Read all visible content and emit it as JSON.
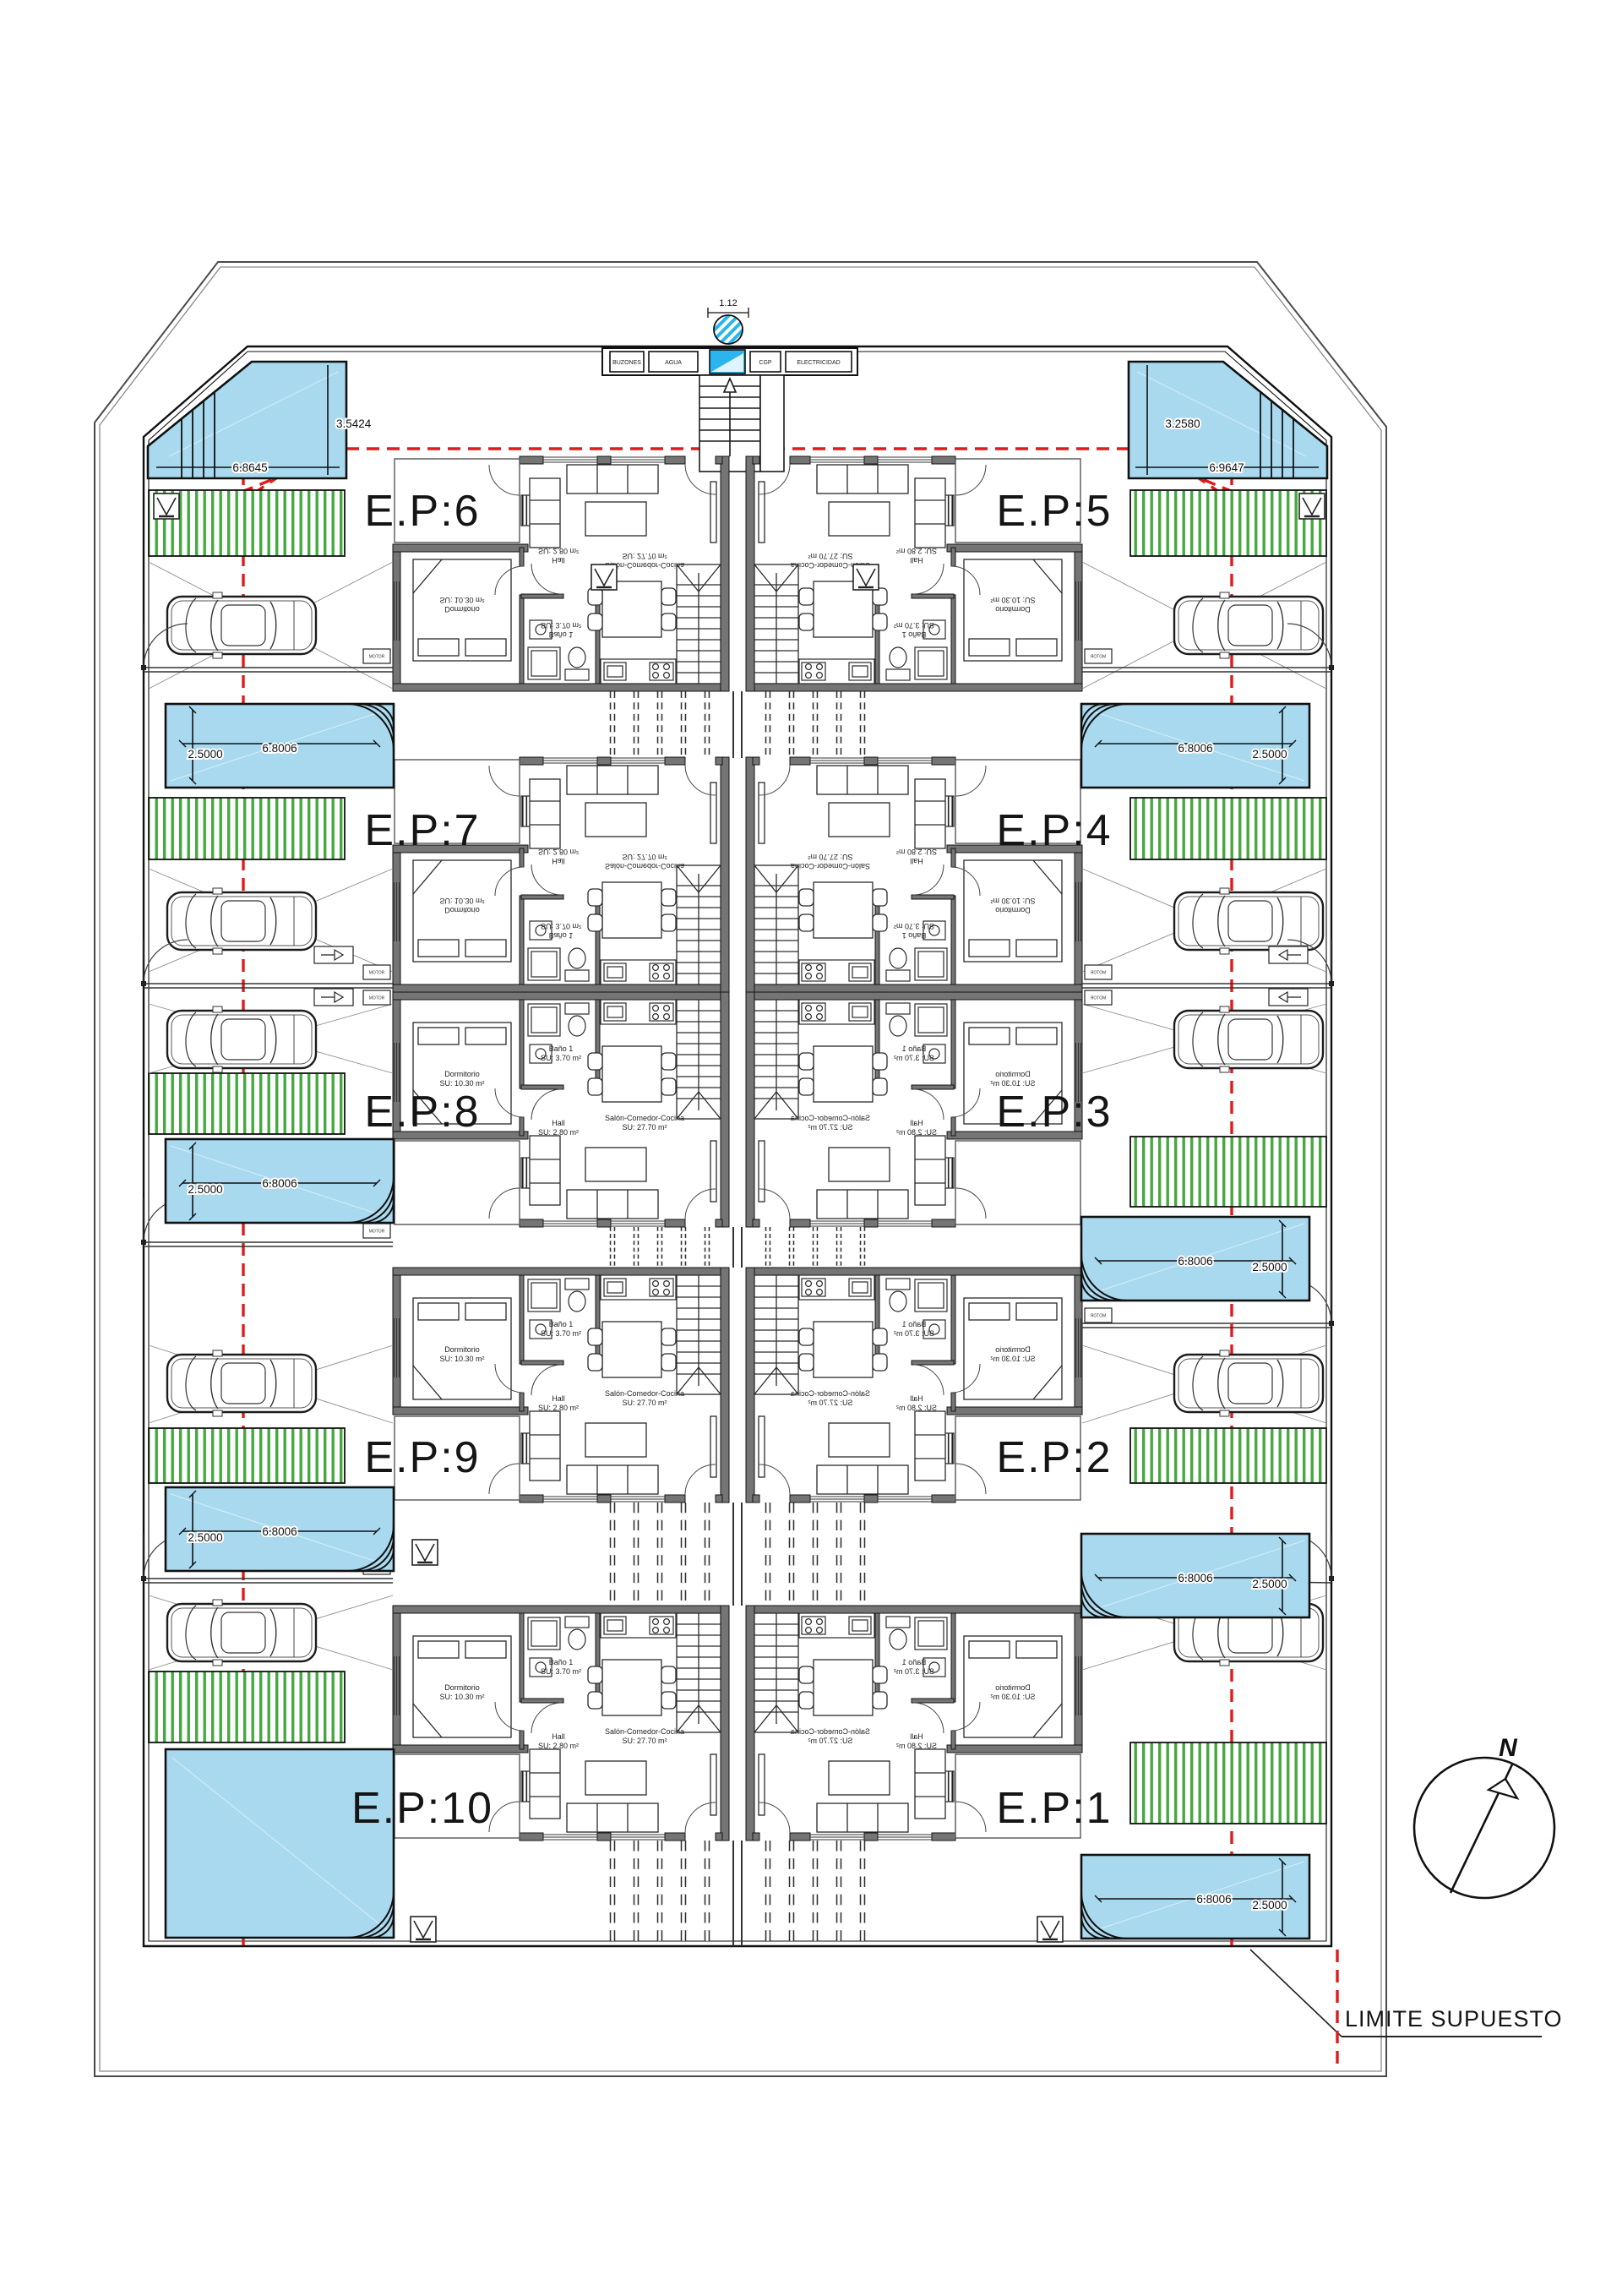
{
  "plan": {
    "units": [
      {
        "id": "ep6",
        "label": "E.P:6"
      },
      {
        "id": "ep5",
        "label": "E.P:5"
      },
      {
        "id": "ep7",
        "label": "E.P:7"
      },
      {
        "id": "ep4",
        "label": "E.P:4"
      },
      {
        "id": "ep8",
        "label": "E.P:8"
      },
      {
        "id": "ep3",
        "label": "E.P:3"
      },
      {
        "id": "ep9",
        "label": "E.P:9"
      },
      {
        "id": "ep2",
        "label": "E.P:2"
      },
      {
        "id": "ep10",
        "label": "E.P:10"
      },
      {
        "id": "ep1",
        "label": "E.P:1"
      }
    ],
    "rooms": {
      "dormitorio": {
        "l1": "Dormitorio",
        "l2": "SU: 10.30 m²"
      },
      "bano": {
        "l1": "Baño 1",
        "l2": "SU: 3.70 m²"
      },
      "hall": {
        "l1": "Hall",
        "l2": "SU: 2.80 m²"
      },
      "salon": {
        "l1": "Salón-Comedor-Cocina",
        "l2": "SU: 27.70 m²"
      }
    },
    "pools": [
      {
        "id": "top-left",
        "width_label": "6.8645",
        "height_label": "3.5424"
      },
      {
        "id": "top-right",
        "width_label": "6.9647",
        "height_label": "3.2580"
      },
      {
        "id": "left-row2",
        "width_label": "6.8006",
        "height_label": "2.5000"
      },
      {
        "id": "left-row3",
        "width_label": "6.8006",
        "height_label": "2.5000"
      },
      {
        "id": "left-row4",
        "width_label": "6.8006",
        "height_label": "2.5000"
      },
      {
        "id": "right-row2",
        "width_label": "6.8006",
        "height_label": "2.5000"
      },
      {
        "id": "right-row3",
        "width_label": "6.8006",
        "height_label": "2.5000"
      },
      {
        "id": "right-row4",
        "width_label": "6.8006",
        "height_label": "2.5000"
      },
      {
        "id": "bottom-right",
        "width_label": "6.8006",
        "height_label": "2.5000"
      },
      {
        "id": "bottom-left-large"
      }
    ],
    "utilities": {
      "boxes": [
        "BUZONES",
        "AGUA",
        "CGP",
        "ELECTRICIDAD"
      ],
      "top_dim": "1.12"
    },
    "equipment": {
      "motor": "MOTOR"
    },
    "compass": {
      "north": "N"
    },
    "boundary": {
      "limit_label": "LIMITE SUPUESTO"
    },
    "colors": {
      "pool_blue": "#a9d9ee",
      "utility_blue": "#2ab5ee",
      "garden_green": "#44a93f",
      "boundary_red": "#e01b1b",
      "wall_gray": "#757575"
    }
  }
}
